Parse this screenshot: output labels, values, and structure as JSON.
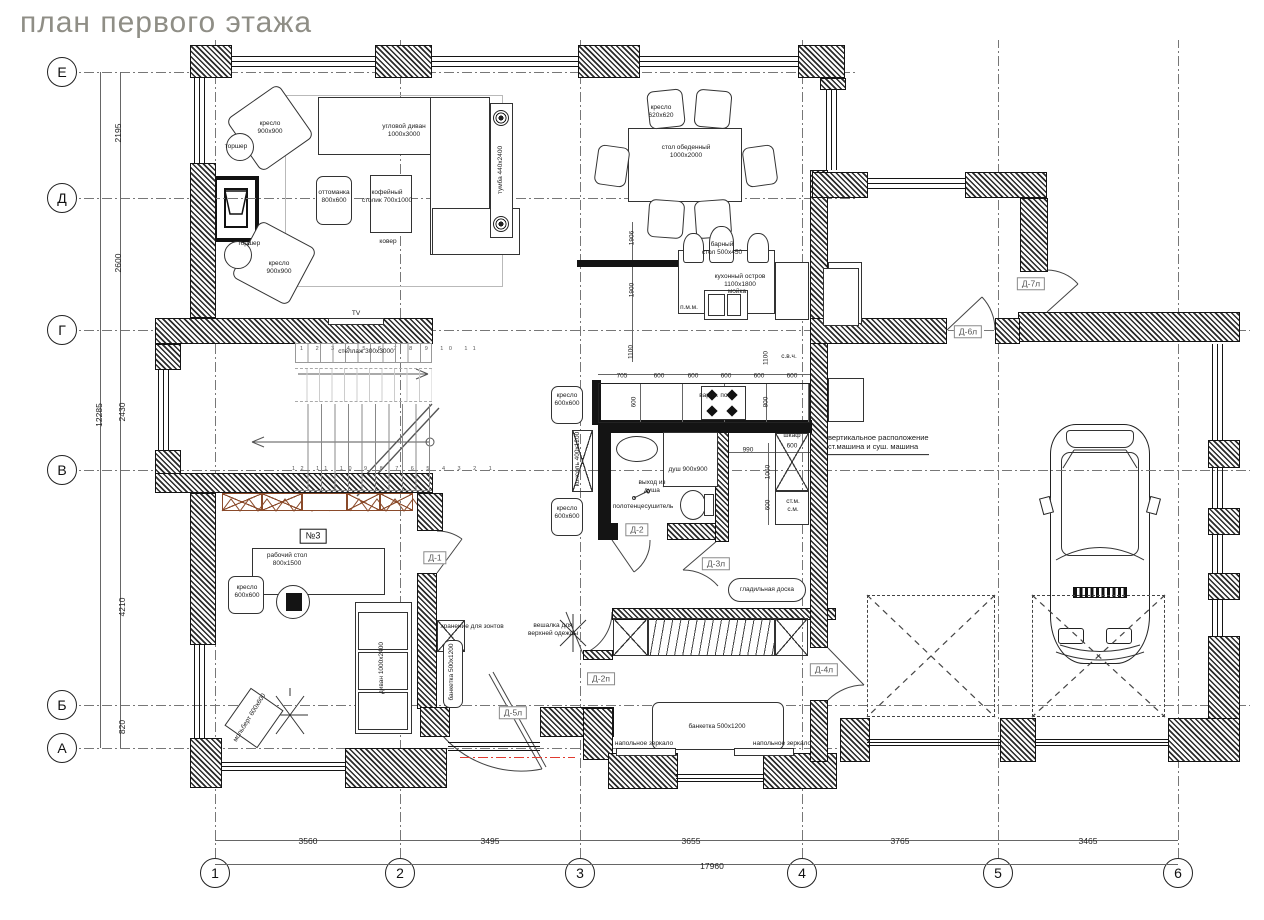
{
  "title": "план первого этажа",
  "colors": {
    "title": "#8f8e86",
    "red_accent": "#e03a2f",
    "wood": "#8a4a2a",
    "ink": "#141414"
  },
  "axes": {
    "rows": [
      {
        "label": "Е",
        "y": 72
      },
      {
        "label": "Д",
        "y": 198
      },
      {
        "label": "Г",
        "y": 330
      },
      {
        "label": "В",
        "y": 470
      },
      {
        "label": "Б",
        "y": 705
      },
      {
        "label": "А",
        "y": 748
      }
    ],
    "cols": [
      {
        "label": "1",
        "x": 215
      },
      {
        "label": "2",
        "x": 400
      },
      {
        "label": "3",
        "x": 580
      },
      {
        "label": "4",
        "x": 802
      },
      {
        "label": "5",
        "x": 998
      },
      {
        "label": "6",
        "x": 1178
      }
    ]
  },
  "dimensions": {
    "vertical_chain": [
      {
        "t": "2195",
        "x": 118,
        "y": 133
      },
      {
        "t": "2600",
        "x": 118,
        "y": 263
      },
      {
        "t": "2430",
        "x": 122,
        "y": 412
      },
      {
        "t": "4210",
        "x": 122,
        "y": 607
      },
      {
        "t": "820",
        "x": 122,
        "y": 727
      },
      {
        "t": "12285",
        "x": 99,
        "y": 415
      }
    ],
    "bottom_chain": [
      {
        "t": "3560",
        "x": 308,
        "y": 841
      },
      {
        "t": "3495",
        "x": 490,
        "y": 841
      },
      {
        "t": "3655",
        "x": 691,
        "y": 841
      },
      {
        "t": "3765",
        "x": 900,
        "y": 841
      },
      {
        "t": "3465",
        "x": 1088,
        "y": 841
      },
      {
        "t": "17960",
        "x": 712,
        "y": 866
      }
    ],
    "interior": [
      {
        "t": "705",
        "x": 622,
        "y": 376
      },
      {
        "t": "600",
        "x": 659,
        "y": 376
      },
      {
        "t": "600",
        "x": 693,
        "y": 376
      },
      {
        "t": "600",
        "x": 726,
        "y": 376
      },
      {
        "t": "600",
        "x": 759,
        "y": 376
      },
      {
        "t": "600",
        "x": 792,
        "y": 376
      },
      {
        "t": "990",
        "x": 748,
        "y": 450
      },
      {
        "t": "600",
        "x": 792,
        "y": 446
      },
      {
        "t": "1906",
        "x": 632,
        "y": 238,
        "rot": 1
      },
      {
        "t": "1900",
        "x": 632,
        "y": 290,
        "rot": 1
      },
      {
        "t": "1100",
        "x": 631,
        "y": 352,
        "rot": 1
      },
      {
        "t": "600",
        "x": 634,
        "y": 402,
        "rot": 1
      },
      {
        "t": "1100",
        "x": 766,
        "y": 358,
        "rot": 1
      },
      {
        "t": "800",
        "x": 766,
        "y": 402,
        "rot": 1
      },
      {
        "t": "1060",
        "x": 768,
        "y": 472,
        "rot": 1
      },
      {
        "t": "600",
        "x": 768,
        "y": 505,
        "rot": 1
      }
    ]
  },
  "door_tags": [
    {
      "t": "Д-1",
      "x": 435,
      "y": 558
    },
    {
      "t": "Д-2",
      "x": 637,
      "y": 530
    },
    {
      "t": "Д-3л",
      "x": 716,
      "y": 564
    },
    {
      "t": "Д-4л",
      "x": 824,
      "y": 670
    },
    {
      "t": "Д-5л",
      "x": 513,
      "y": 713
    },
    {
      "t": "Д-2п",
      "x": 601,
      "y": 679
    },
    {
      "t": "Д-6л",
      "x": 968,
      "y": 332
    },
    {
      "t": "Д-7л",
      "x": 1031,
      "y": 284
    }
  ],
  "room_number": {
    "t": "№3",
    "x": 313,
    "y": 536
  },
  "room_labels": [
    {
      "t": "кресло\n900х900",
      "x": 270,
      "y": 128
    },
    {
      "t": "торшер",
      "x": 236,
      "y": 147
    },
    {
      "t": "угловой диван\n1000х3000",
      "x": 404,
      "y": 131
    },
    {
      "t": "оттоманка\n800х600",
      "x": 334,
      "y": 197
    },
    {
      "t": "кофейный\nстолик 700х1000",
      "x": 387,
      "y": 197
    },
    {
      "t": "ковер",
      "x": 388,
      "y": 242
    },
    {
      "t": "торшер",
      "x": 249,
      "y": 244
    },
    {
      "t": "кресло\n900х900",
      "x": 279,
      "y": 268
    },
    {
      "t": "тумба 440х2400",
      "x": 501,
      "y": 170,
      "rot": -90
    },
    {
      "t": "TV",
      "x": 356,
      "y": 314
    },
    {
      "t": "стеллаж 300х3000",
      "x": 366,
      "y": 352
    },
    {
      "t": "кресло\n620х620",
      "x": 661,
      "y": 112
    },
    {
      "t": "стол обеденный\n1000х2000",
      "x": 686,
      "y": 152
    },
    {
      "t": "барный\nстол 500х450",
      "x": 722,
      "y": 249
    },
    {
      "t": "кухонный остров\n1100х1800",
      "x": 740,
      "y": 281
    },
    {
      "t": "мойка",
      "x": 737,
      "y": 292
    },
    {
      "t": "п.м.м.",
      "x": 689,
      "y": 308
    },
    {
      "t": "вароч. пов.",
      "x": 716,
      "y": 396
    },
    {
      "t": "с.в.ч.",
      "x": 789,
      "y": 357
    },
    {
      "t": "шкаф",
      "x": 792,
      "y": 436
    },
    {
      "t": "ст.м.\nс.м.",
      "x": 793,
      "y": 506
    },
    {
      "t": "кресло\n600х600",
      "x": 567,
      "y": 400
    },
    {
      "t": "кресло\n600х600",
      "x": 567,
      "y": 513
    },
    {
      "t": "консоль 400х1200",
      "x": 578,
      "y": 459,
      "rot": -90
    },
    {
      "t": "душ 900х900",
      "x": 688,
      "y": 470
    },
    {
      "t": "выход из\nдуша",
      "x": 652,
      "y": 487
    },
    {
      "t": "полотенцесушитель",
      "x": 643,
      "y": 507
    },
    {
      "t": "рабочий стол\n800х1500",
      "x": 287,
      "y": 560
    },
    {
      "t": "кресло\n600х600",
      "x": 247,
      "y": 592
    },
    {
      "t": "диван 1000х2400",
      "x": 382,
      "y": 668,
      "rot": -90
    },
    {
      "t": "мольберт\n600х600",
      "x": 250,
      "y": 718,
      "rot": -58
    },
    {
      "t": "хранение для зонтов",
      "x": 472,
      "y": 627
    },
    {
      "t": "банкетка 500х1200",
      "x": 452,
      "y": 672,
      "rot": -90
    },
    {
      "t": "вешалка для\nверхней одежды",
      "x": 553,
      "y": 630
    },
    {
      "t": "гладильная доска",
      "x": 767,
      "y": 590
    },
    {
      "t": "банкетка 500х1200",
      "x": 717,
      "y": 727
    },
    {
      "t": "напольное зеркало",
      "x": 644,
      "y": 744
    },
    {
      "t": "напольное зеркало",
      "x": 782,
      "y": 744
    },
    {
      "t": "вертикальное расположение\nст.машина и суш. машина",
      "x": 828,
      "y": 444,
      "la": 1,
      "ul": 1
    }
  ],
  "stairs": {
    "top_numbers": "1 2 3 4 5 6 7 8 9 10 11",
    "bottom_numbers": "12 11 10 9 8 7 6 5 4 3 2 1"
  }
}
